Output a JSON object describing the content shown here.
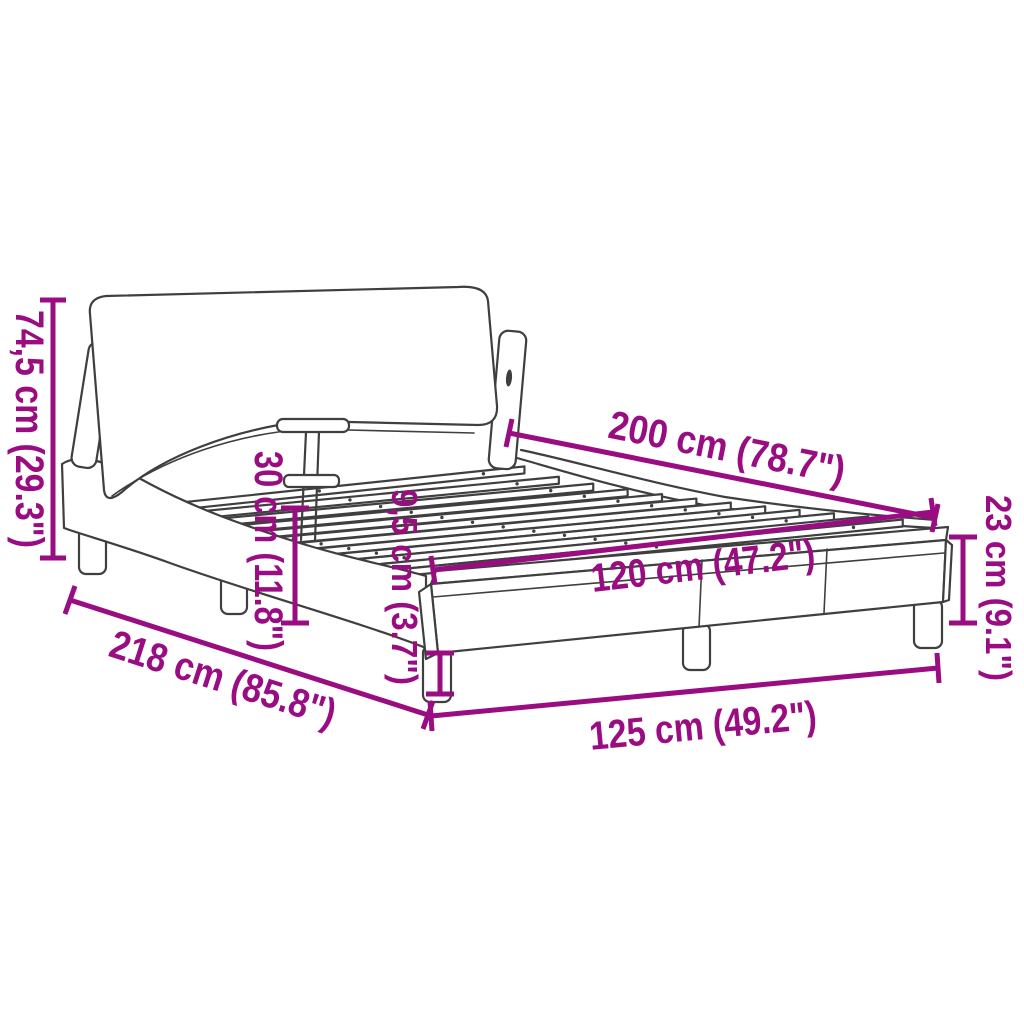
{
  "page": {
    "background": "#ffffff"
  },
  "diagram": {
    "title": "bed-frame-with-headboard-dimension-diagram",
    "accent_color": "#9a0c82",
    "line_color": "#3f3f3f",
    "slat_count": 12,
    "dimensions": {
      "headboard_height": "74,5 cm (29.3\")",
      "inner_length": "200 cm (78.7\")",
      "base_height": "30 cm (11.8\")",
      "leg_height": "9,5 cm (3.7\")",
      "slat_width": "120 cm (47.2\")",
      "foot_height": "23 cm (9.1\")",
      "total_length": "218 cm (85.8\")",
      "total_width": "125 cm (49.2\")"
    }
  }
}
